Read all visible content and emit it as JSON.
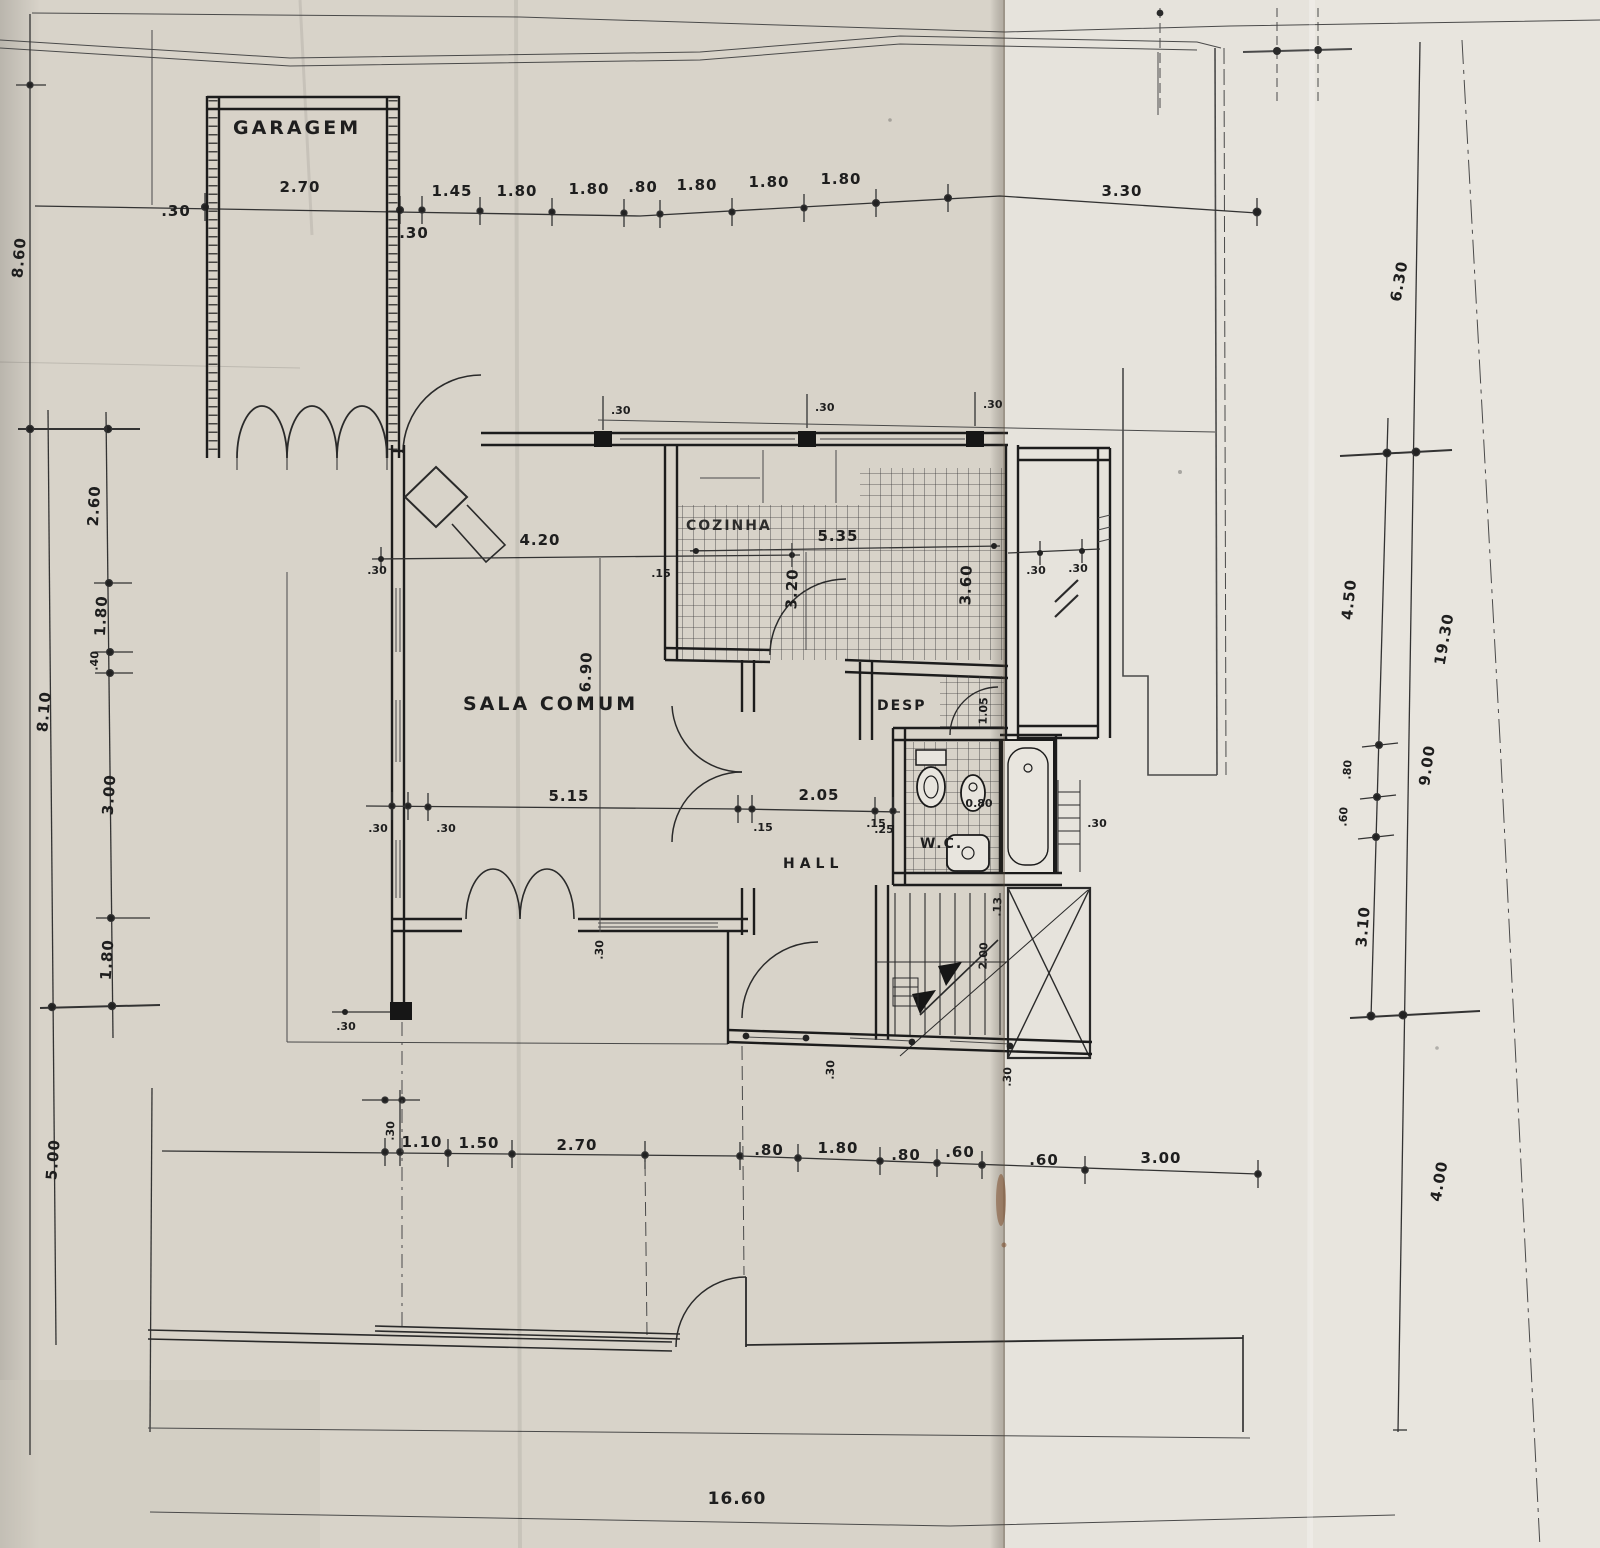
{
  "document_type": "scanned architectural floor plan",
  "labels": {
    "garagem": "GARAGEM",
    "sala": "SALA COMUM",
    "cozinha": "COZINHA",
    "desp": "DESP",
    "wc": "W.C.",
    "hall": "HALL",
    "total": "16.60"
  },
  "dims": {
    "top": [
      ".30",
      "2.70",
      ".30",
      "1.45",
      "1.80",
      "1.80",
      ".80",
      "1.80",
      "1.80",
      "1.80",
      "3.30"
    ],
    "left": [
      "8.60",
      "2.60",
      "1.80",
      ".40",
      "8.10",
      "3.00",
      "1.80",
      "5.00"
    ],
    "right": [
      "6.30",
      "4.50",
      "19.30",
      ".80",
      ".60",
      "9.00",
      "3.10",
      "4.00"
    ],
    "mid": [
      ".30",
      ".30",
      "5.15",
      ".15",
      "2.05",
      ".15"
    ],
    "bottom": [
      ".30",
      "1.10",
      "1.50",
      "2.70",
      ".80",
      "1.80",
      ".80",
      ".60",
      ".60",
      "3.00"
    ],
    "sala": [
      "4.20",
      ".30",
      ".15",
      "6.90",
      ".30",
      ".30"
    ],
    "kitchen": [
      "5.35",
      "3.20",
      "3.60",
      ".30",
      ".30"
    ],
    "pillars": [
      ".30",
      ".30",
      ".30"
    ],
    "wc": [
      ".25",
      "0.80",
      ".30"
    ],
    "desp": [
      "1.05"
    ],
    "stairs": [
      ".13",
      "2.00",
      ".30",
      ".30"
    ]
  },
  "colors": {
    "paper_left": "#d8d3c9",
    "paper_right": "#e6e3dc",
    "ink": "#222222"
  }
}
